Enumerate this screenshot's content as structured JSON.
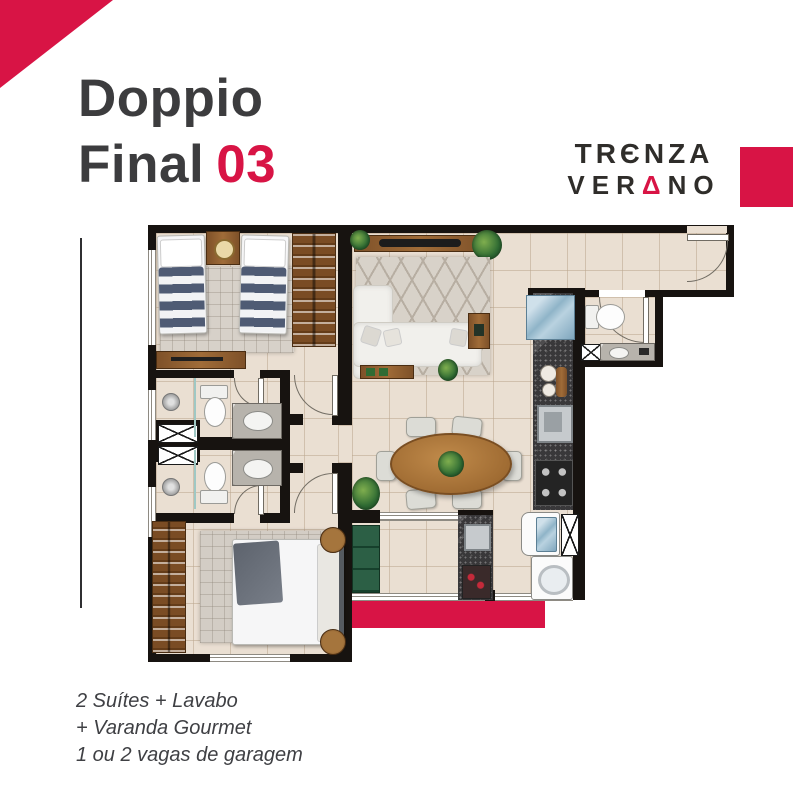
{
  "header": {
    "title_line1": "Doppio",
    "title_line2": "Final",
    "unit_number": "03"
  },
  "brand": {
    "name_line1_pre": "TR",
    "name_line1_e": "Є",
    "name_line1_post": "NZA",
    "name_line2_pre": "VER",
    "name_line2_a": "Δ",
    "name_line2_post": "NO"
  },
  "features": {
    "line1": "2 Suítes + Lavabo",
    "line2": "+ Varanda Gourmet",
    "line3": "1 ou 2 vagas de garagem"
  },
  "colors": {
    "brand_red": "#d81445",
    "title_gray": "#3c3c3e",
    "wall_black": "#171310",
    "floor_beige": "#eadfd2"
  }
}
